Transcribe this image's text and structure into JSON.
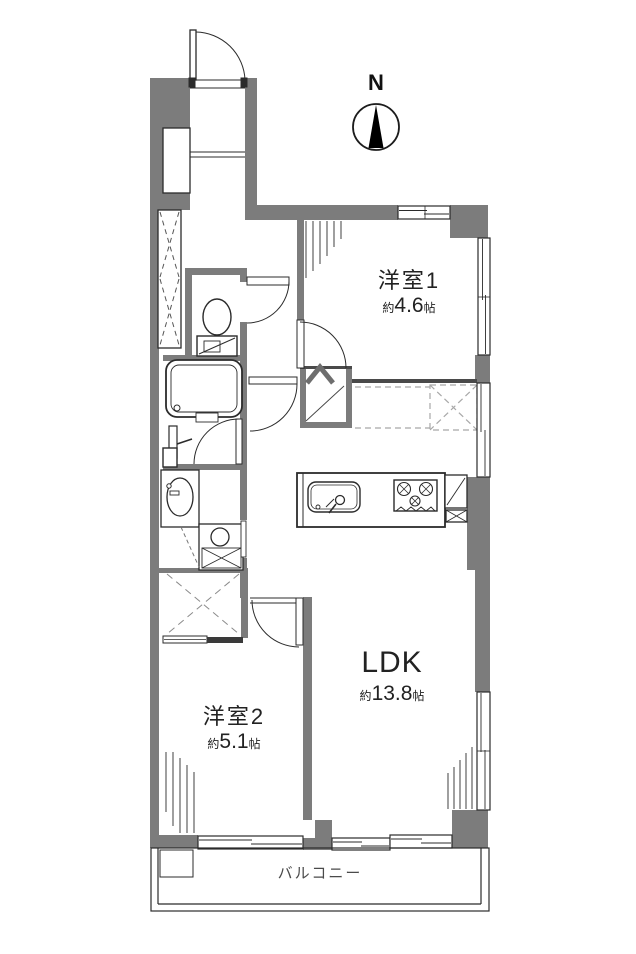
{
  "plan_type": "floorplan",
  "north": {
    "label": "N"
  },
  "balcony": {
    "label": "バルコニー"
  },
  "rooms": {
    "room1": {
      "name": "洋室1",
      "size_prefix": "約",
      "size_value": "4.6",
      "size_unit": "帖"
    },
    "ldk": {
      "name": "LDK",
      "size_prefix": "約",
      "size_value": "13.8",
      "size_unit": "帖"
    },
    "room2": {
      "name": "洋室2",
      "size_prefix": "約",
      "size_value": "5.1",
      "size_unit": "帖"
    }
  },
  "colors": {
    "wall": "#7c7c7c",
    "line": "#2b2b2b",
    "dash": "#a8a8a8",
    "background": "#ffffff"
  }
}
